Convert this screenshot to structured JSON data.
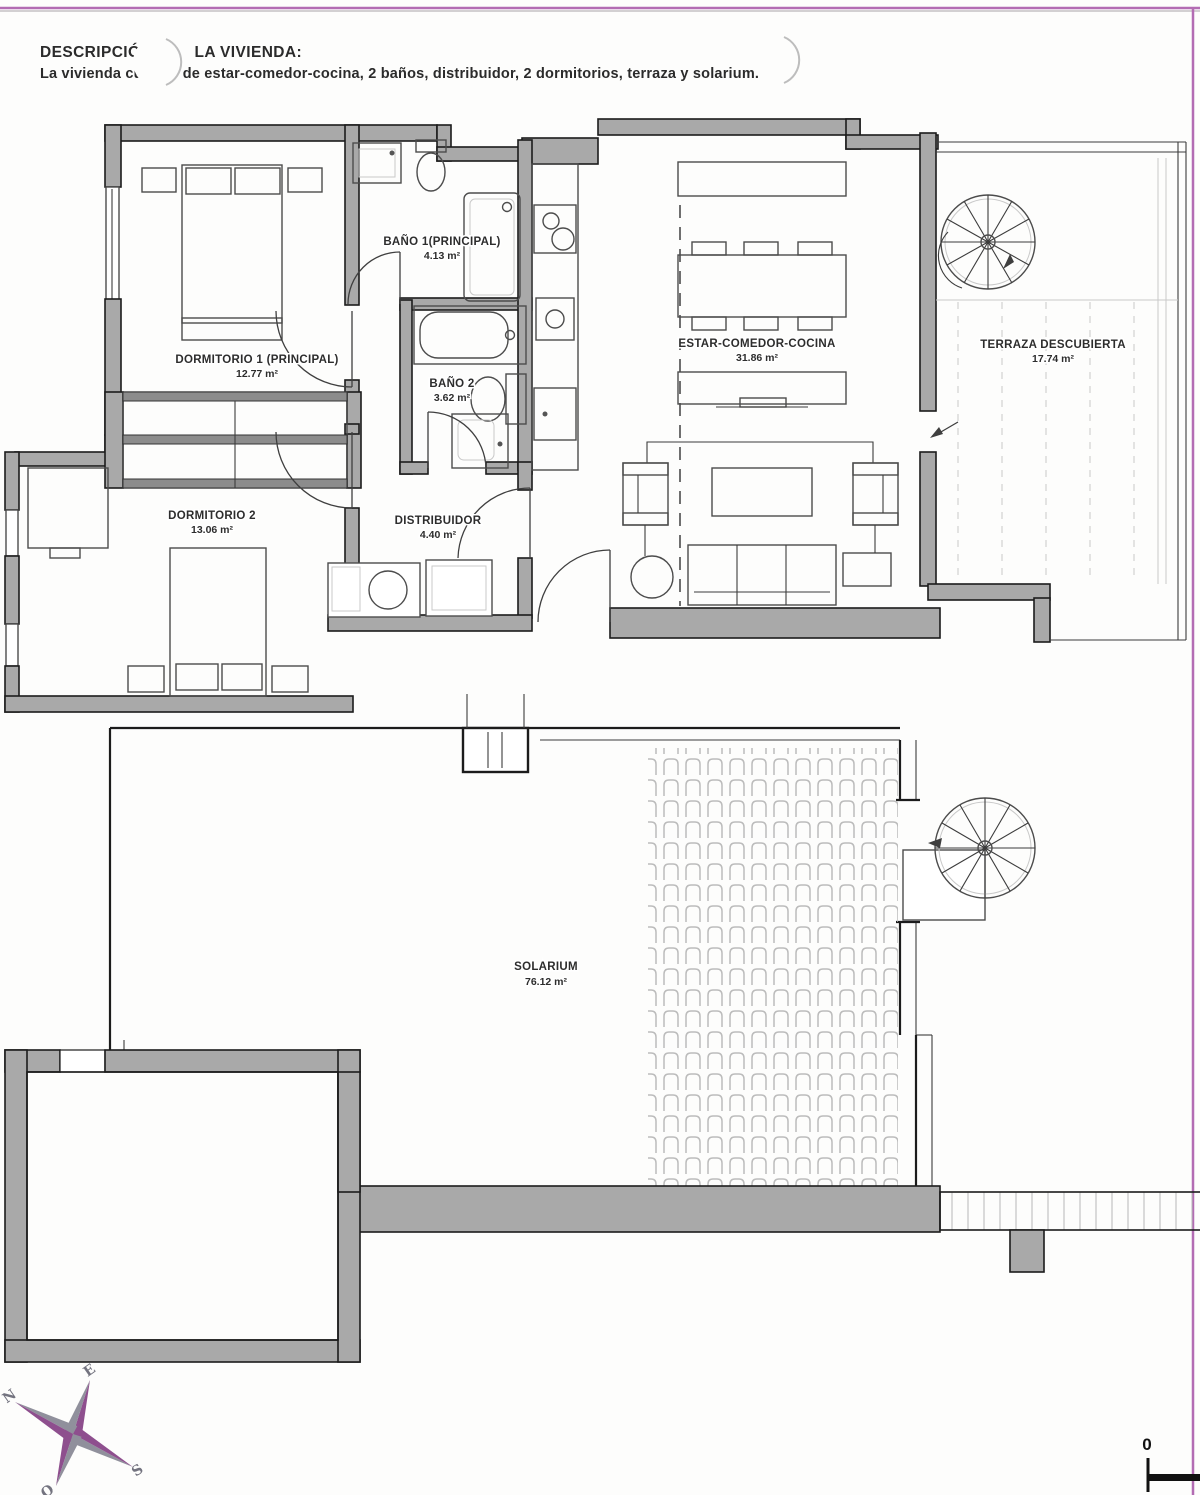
{
  "header": {
    "title_left": "DESCRIPCIÓ",
    "title_right": "LA VIVIENDA:",
    "desc_left": "La vivienda cu",
    "desc_right": "de estar-comedor-cocina, 2 baños, distribuidor, 2 dormitorios, terraza y solarium."
  },
  "plans": {
    "upper": {
      "rooms": [
        {
          "name": "DORMITORIO 1 (PRINCIPAL)",
          "area": "12.77 m²"
        },
        {
          "name": "BAÑO 1(PRINCIPAL)",
          "area": "4.13 m²"
        },
        {
          "name": "BAÑO 2",
          "area": "3.62 m²"
        },
        {
          "name": "DISTRIBUIDOR",
          "area": "4.40 m²"
        },
        {
          "name": "DORMITORIO 2",
          "area": "13.06 m²"
        },
        {
          "name": "ESTAR-COMEDOR-COCINA",
          "area": "31.86 m²"
        },
        {
          "name": "TERRAZA DESCUBIERTA",
          "area": "17.74 m²"
        }
      ]
    },
    "lower": {
      "rooms": [
        {
          "name": "SOLARIUM",
          "area": "76.12 m²"
        }
      ]
    }
  },
  "compass": {
    "n": "N",
    "e": "E",
    "s": "S",
    "o": "O"
  },
  "scale_bar": {
    "zero": "0"
  },
  "colors": {
    "page_border": "#b36cb3",
    "wall_gray": "#a9a9a9",
    "compass_purple": "#8e4f8e",
    "compass_gray": "#90909c"
  }
}
